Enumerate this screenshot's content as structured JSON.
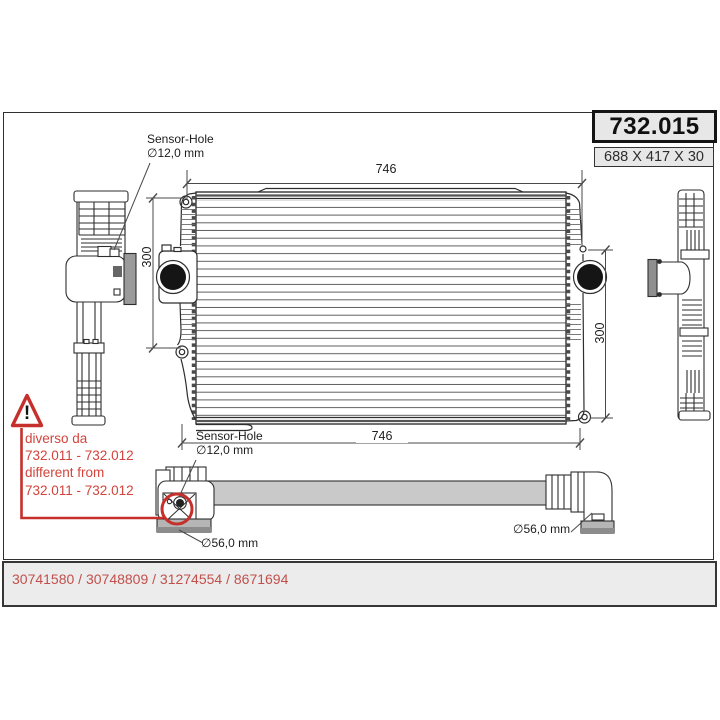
{
  "header": {
    "part_number": "732.015",
    "size": "688 X 417 X 30"
  },
  "drawing": {
    "sensor_hole_top": {
      "title": "Sensor-Hole",
      "diameter": "∅12,0 mm"
    },
    "sensor_hole_bottom": {
      "title": "Sensor-Hole",
      "diameter": "∅12,0 mm"
    },
    "dim_width_top": "746",
    "dim_width_bottom": "746",
    "dim_height_left": "300",
    "dim_height_right": "300",
    "dim_port_left": "∅56,0 mm",
    "dim_port_right": "∅56,0 mm"
  },
  "warning": {
    "symbol": "!",
    "lines": [
      "diverso da",
      "732.011 - 732.012",
      "different from",
      "732.011 - 732.012"
    ]
  },
  "footer": {
    "oe_numbers": "30741580 / 30748809 / 31274554 / 8671694"
  },
  "colors": {
    "accent_red": "#c5302c",
    "warning_text_red": "#d2443c",
    "footer_text_red": "#c1504c",
    "line": "#2e2e2e",
    "gray_fill": "#c9c9c9",
    "box_background": "#e7e7e7"
  }
}
